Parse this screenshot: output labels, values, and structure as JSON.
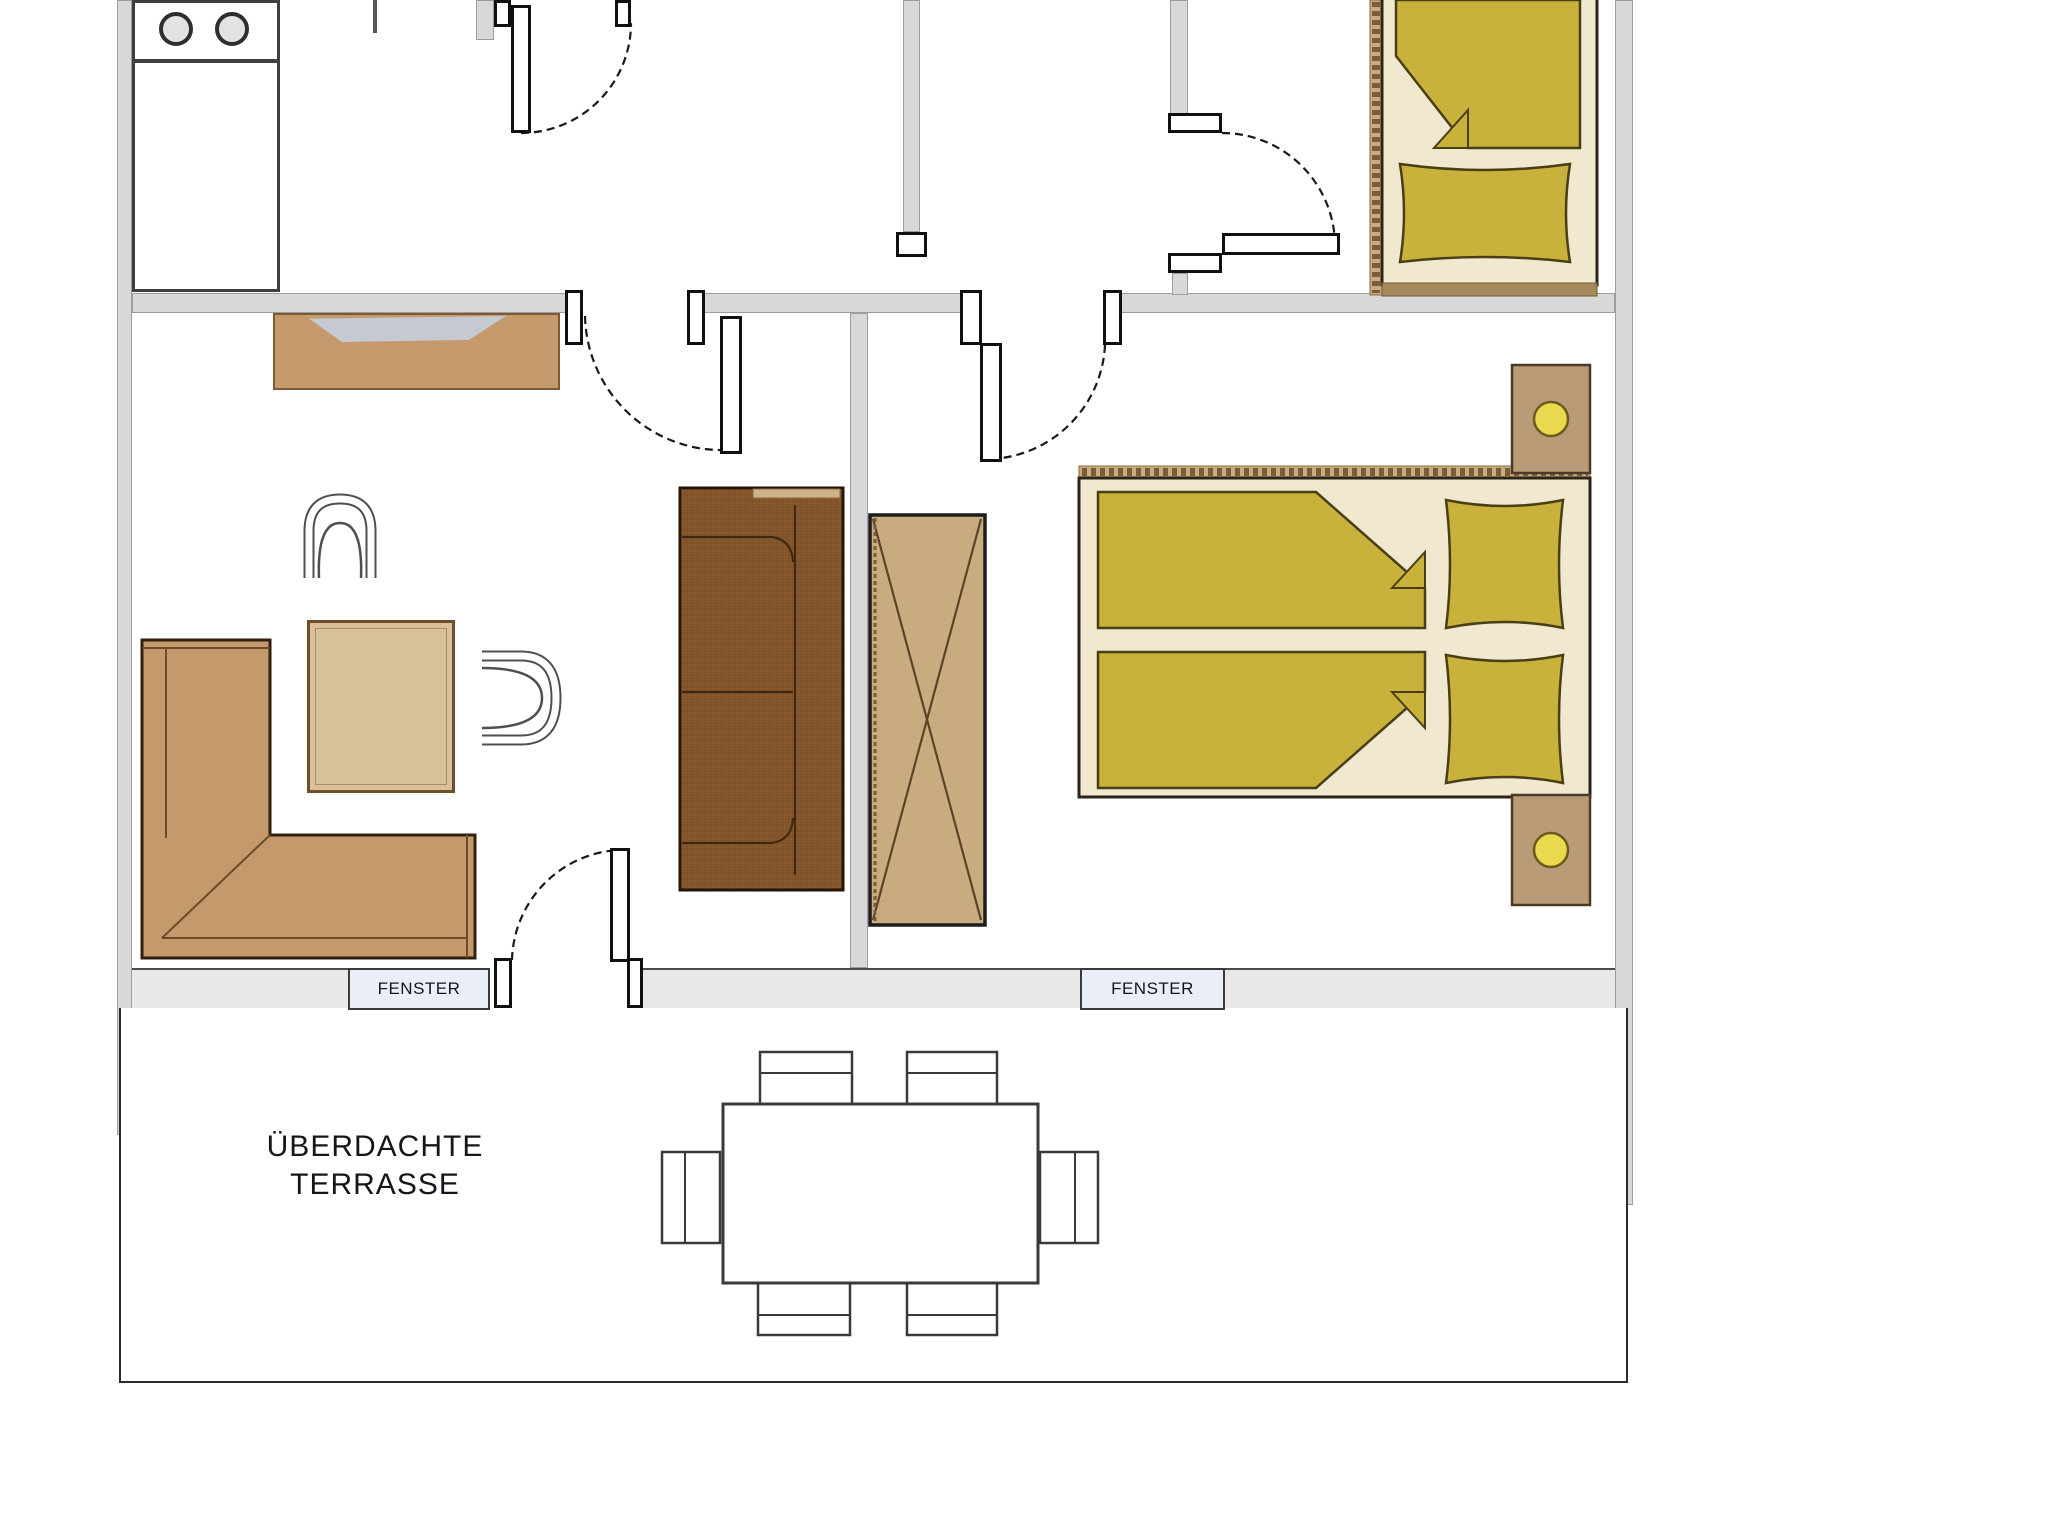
{
  "document": {
    "type": "apartment floor plan",
    "background": "#ffffff"
  },
  "labels": {
    "window_left": "FENSTER",
    "window_right": "FENSTER",
    "terrace_line1": "ÜBERDACHTE",
    "terrace_line2": "TERRASSE"
  },
  "rooms": [
    {
      "id": "kitchen",
      "furniture": [
        "stove-two-burners",
        "kitchen-counter"
      ]
    },
    {
      "id": "hallway",
      "furniture": [
        "entry-door"
      ]
    },
    {
      "id": "living-room",
      "furniture": [
        "sideboard",
        "tv",
        "armchair",
        "armchair",
        "coffee-table",
        "corner-sofa",
        "sofa"
      ]
    },
    {
      "id": "bedroom",
      "furniture": [
        "wardrobe",
        "double-bed",
        "nightstand-with-lamp",
        "nightstand-with-lamp"
      ]
    },
    {
      "id": "single-bedroom",
      "furniture": [
        "single-bed"
      ]
    },
    {
      "id": "terrace",
      "furniture": [
        "dining-table",
        "chair",
        "chair",
        "chair",
        "chair",
        "chair",
        "chair"
      ]
    }
  ],
  "colors": {
    "wall": "#d8d8d8",
    "sill_band": "#e8e8e8",
    "window_fill": "#eaeff7",
    "wood_light": "#c49a6c",
    "wood_mid": "#b99b78",
    "sofa_dark": "#8a5a2e",
    "wardrobe": "#c9ab80",
    "bed_frame": "#f0e8cf",
    "duvet_olive": "#c9b23c",
    "lamp_yellow": "#ead94e",
    "outline": "#1a1a1a"
  }
}
